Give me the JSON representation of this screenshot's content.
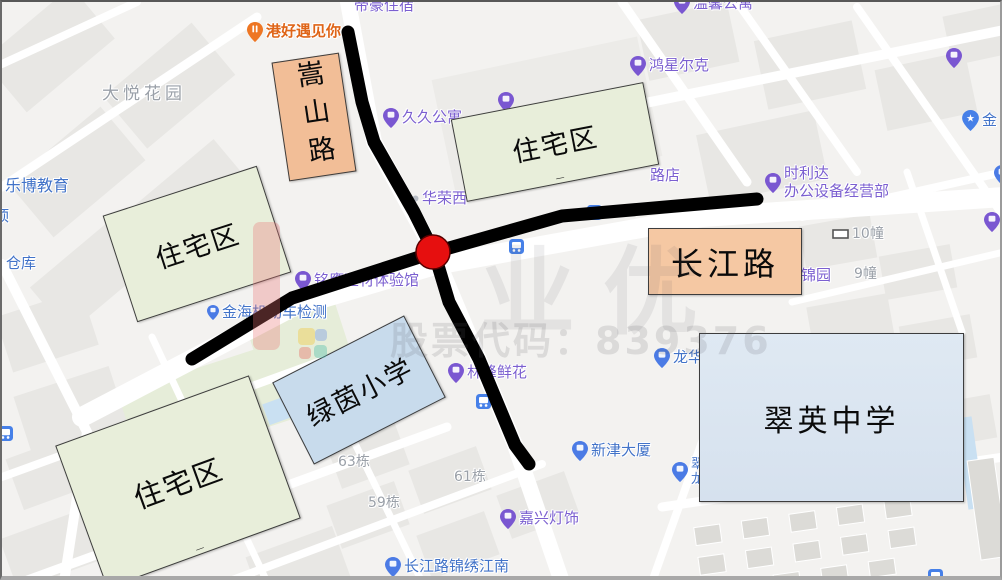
{
  "colors": {
    "map_background": "#f3f2f0",
    "road_annotation": "#000000",
    "intersection_marker": "#E60F0F",
    "residential_box_fill": "#E8EEDA",
    "road_label_box_fill": "#F2BE97",
    "primary_school_box_fill": "#C8DBEC",
    "middle_school_box_fill": "#DAE4F0",
    "poi_purple": "#7B5FD0",
    "poi_blue": "#4273C8",
    "poi_gray": "#9AA0A8",
    "poi_orange": "#DF6518",
    "pin_purple": "#7A57D1",
    "pin_blue": "#4B7BE5",
    "pin_orange": "#EE7623",
    "pin_bus": "#4680E8"
  },
  "watermark": {
    "brand_text": "业优",
    "stock_code_text": "股票代码：839376"
  },
  "annotations": {
    "boxes": [
      {
        "id": "songshan-road-label-box",
        "label": "嵩山路",
        "fill": "#F2BE97"
      },
      {
        "id": "residential-area-top",
        "label": "住宅区",
        "artifact": "_",
        "fill": "#E8EEDA"
      },
      {
        "id": "residential-area-left",
        "label": "住宅区",
        "fill": "#E8EEDA"
      },
      {
        "id": "residential-area-bottom",
        "label": "住宅区",
        "artifact": "_",
        "fill": "#E8EEDA"
      },
      {
        "id": "lvyin-primary-school-box",
        "label": "绿茵小学",
        "fill": "#C8DBEC"
      },
      {
        "id": "changjiang-road-label-box",
        "label": "长江路",
        "fill": "#F5C8A3"
      },
      {
        "id": "cuiying-middle-school-box",
        "label": "翠英中学",
        "fill": "#DAE4F0"
      }
    ],
    "roads": [
      {
        "id": "songshan-road-line",
        "label": "嵩山路"
      },
      {
        "id": "changjiang-road-line",
        "label": "长江路"
      }
    ],
    "intersection_marker": {
      "shape": "red-circle",
      "color": "#E60F0F"
    }
  },
  "map": {
    "pois": [
      {
        "id": "poi-dayue-huayuan",
        "text": "大悦花园",
        "x": 100,
        "y": 82,
        "color": "gray",
        "size": 17,
        "spacing": 4
      },
      {
        "id": "poi-ganghao-yujianni",
        "text": "港好遇见你",
        "x": 245,
        "y": 20,
        "color": "orange",
        "pin": "orange",
        "size": 15
      },
      {
        "id": "poi-dihao-zhusu",
        "text": "帝豪住宿",
        "x": 352,
        "y": -5,
        "color": "purple",
        "size": 15
      },
      {
        "id": "poi-wenxin-gongyu",
        "text": "温馨公寓",
        "x": 672,
        "y": -8,
        "color": "purple",
        "pin": "purple",
        "size": 15
      },
      {
        "id": "poi-jiujiu-gongyu",
        "text": "久久公寓",
        "x": 381,
        "y": 106,
        "color": "purple",
        "pin": "purple",
        "size": 15
      },
      {
        "id": "poi-hongxing-erke",
        "text": "鸿星尔克",
        "x": 628,
        "y": 54,
        "color": "purple",
        "pin": "purple",
        "size": 15
      },
      {
        "id": "poi-shilida-bangong",
        "text": "时利达\n办公设备经营部",
        "x": 763,
        "y": 163,
        "color": "purple",
        "pin": "purple",
        "size": 15
      },
      {
        "id": "poi-huarong-xi",
        "text": "华荣西",
        "x": 410,
        "y": 188,
        "color": "purple",
        "pin": "dot",
        "size": 15
      },
      {
        "id": "poi-ludian-partial",
        "text": "路店",
        "x": 648,
        "y": 165,
        "color": "purple",
        "size": 15
      },
      {
        "id": "poi-jinyuan",
        "text": "锦园",
        "x": 799,
        "y": 265,
        "color": "purple",
        "size": 15
      },
      {
        "id": "poi-10-zhuang",
        "text": "10幢",
        "x": 830,
        "y": 224,
        "color": "gray",
        "pin": "rect",
        "size": 14
      },
      {
        "id": "poi-9-zhuang",
        "text": "9幢",
        "x": 852,
        "y": 264,
        "color": "gray",
        "size": 14
      },
      {
        "id": "poi-mingying-jiancai",
        "text": "铭鹰建材体验馆",
        "x": 293,
        "y": 269,
        "color": "purple",
        "pin": "purple",
        "size": 15
      },
      {
        "id": "poi-jinhai-jidongche",
        "text": "金海机动车检测",
        "x": 205,
        "y": 302,
        "color": "blue",
        "pin": "blue-small",
        "size": 15
      },
      {
        "id": "poi-cangku-partial",
        "text": "仓库",
        "x": 4,
        "y": 253,
        "color": "blue",
        "size": 15
      },
      {
        "id": "poi-ding-partial",
        "text": "顶",
        "x": -8,
        "y": 206,
        "color": "blue",
        "size": 15
      },
      {
        "id": "poi-lebo-jiaoyu",
        "text": "乐博教育",
        "x": 3,
        "y": 175,
        "color": "blue",
        "size": 16
      },
      {
        "id": "poi-linfeng-xianhua",
        "text": "林峰鲜花",
        "x": 446,
        "y": 361,
        "color": "purple",
        "pin": "purple",
        "size": 15
      },
      {
        "id": "poi-xinjin-dasha",
        "text": "新津大厦",
        "x": 570,
        "y": 439,
        "color": "blue",
        "pin": "blue",
        "size": 15
      },
      {
        "id": "poi-longhua",
        "text": "龙华",
        "x": 652,
        "y": 346,
        "color": "blue",
        "pin": "blue",
        "size": 15
      },
      {
        "id": "poi-cui-long-partial",
        "text": "翠\n龙",
        "x": 670,
        "y": 455,
        "color": "blue",
        "pin": "blue",
        "size": 13
      },
      {
        "id": "poi-jiaxing-dengshi",
        "text": "嘉兴灯饰",
        "x": 498,
        "y": 507,
        "color": "purple",
        "pin": "purple",
        "size": 15
      },
      {
        "id": "poi-changjianglu-jinxiu-jiangnan",
        "text": "长江路锦绣江南",
        "x": 383,
        "y": 555,
        "color": "blue",
        "pin": "blue",
        "size": 15
      },
      {
        "id": "poi-63-dong",
        "text": "63栋",
        "x": 336,
        "y": 452,
        "color": "gray",
        "size": 14
      },
      {
        "id": "poi-59-dong",
        "text": "59栋",
        "x": 366,
        "y": 493,
        "color": "gray",
        "size": 14
      },
      {
        "id": "poi-61-dong",
        "text": "61栋",
        "x": 452,
        "y": 467,
        "color": "gray",
        "size": 14
      },
      {
        "id": "poi-jin-partial",
        "text": "金",
        "x": 960,
        "y": 108,
        "color": "blue",
        "pin": "star",
        "size": 15
      },
      {
        "id": "icon-bus-1",
        "text": "",
        "x": 585,
        "y": 203,
        "pin": "bus"
      },
      {
        "id": "icon-bus-2",
        "text": "",
        "x": 507,
        "y": 237,
        "pin": "bus"
      },
      {
        "id": "icon-bus-3",
        "text": "",
        "x": 474,
        "y": 392,
        "pin": "bus"
      },
      {
        "id": "icon-bus-4",
        "text": "",
        "x": -4,
        "y": 424,
        "pin": "bus"
      },
      {
        "id": "icon-bus-5",
        "text": "",
        "x": 926,
        "y": 567,
        "pin": "bus"
      },
      {
        "id": "icon-pin-right-top",
        "text": "",
        "x": 944,
        "y": 46,
        "pin": "purple"
      },
      {
        "id": "icon-pin-right-mid",
        "text": "",
        "x": 982,
        "y": 210,
        "pin": "purple"
      },
      {
        "id": "icon-pin-right-edge",
        "text": "",
        "x": 992,
        "y": 163,
        "pin": "blue"
      },
      {
        "id": "icon-pin-top-center",
        "text": "",
        "x": 496,
        "y": 90,
        "pin": "purple"
      }
    ]
  }
}
